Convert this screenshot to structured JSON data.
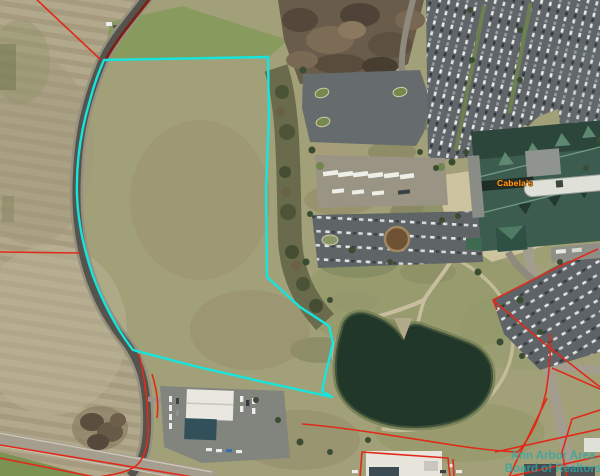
{
  "map": {
    "labels": {
      "store": "Cabela's",
      "watermark_line1": "Ann Arbor Area",
      "watermark_line2": "Board of Realtors"
    },
    "colors": {
      "parcel_highlight": "#14e6de",
      "parcel_lines_red": "#e02a1a",
      "road_overlay_dark_red": "#7d2016",
      "watermark_teal": "#2ba8a8",
      "store_label_orange": "#f2a41c",
      "pond_water": "#20372a"
    }
  }
}
